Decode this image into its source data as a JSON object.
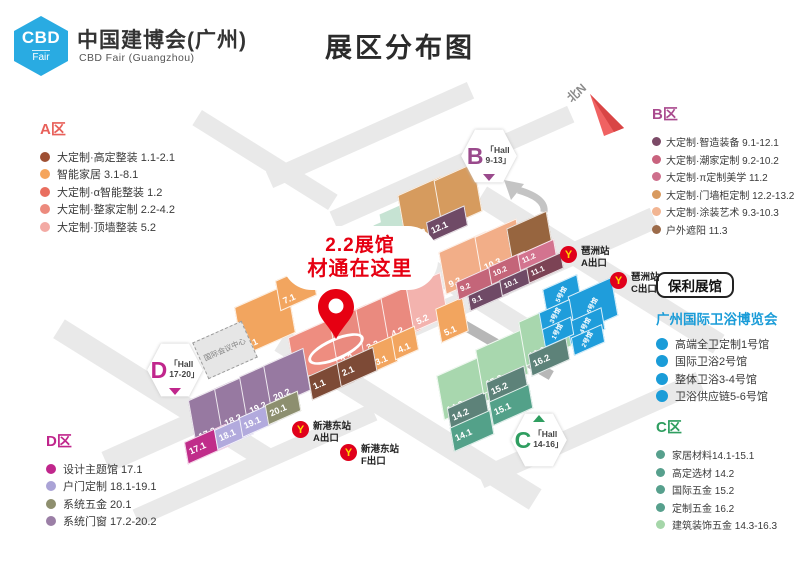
{
  "header": {
    "logo_abbr": "CBD",
    "logo_sub": "Fair",
    "title_cn": "中国建博会(广州)",
    "title_en": "CBD Fair (Guangzhou)",
    "page_title": "展区分布图"
  },
  "compass": {
    "label": "北N"
  },
  "legend_a": {
    "title": "A区",
    "items": [
      {
        "label": "大定制·高定整装 1.1-2.1",
        "color": "#9e4f33"
      },
      {
        "label": "智能家居 3.1-8.1",
        "color": "#f5a55c"
      },
      {
        "label": "大定制·α智能整装 1.2",
        "color": "#e96e5f"
      },
      {
        "label": "大定制·整家定制 2.2-4.2",
        "color": "#ec8a7d"
      },
      {
        "label": "大定制·顶墙整装 5.2",
        "color": "#f3aaa4"
      }
    ]
  },
  "legend_b": {
    "title": "B区",
    "items": [
      {
        "label": "大定制·智造装备 9.1-12.1",
        "color": "#7c4a67"
      },
      {
        "label": "大定制·潮家定制 9.2-10.2",
        "color": "#c9637e"
      },
      {
        "label": "大定制·π定制美学 11.2",
        "color": "#ce6f8c"
      },
      {
        "label": "大定制·门墙柜定制 12.2-13.2",
        "color": "#d89a5f"
      },
      {
        "label": "大定制·涂装艺术 9.3-10.3",
        "color": "#f2b592"
      },
      {
        "label": "户外遮阳 11.3",
        "color": "#9c6b4a"
      }
    ]
  },
  "poly": {
    "badge": "保利展馆",
    "title": "广州国际卫浴博览会",
    "items": [
      {
        "label": "高端全卫定制1号馆"
      },
      {
        "label": "国际卫浴2号馆"
      },
      {
        "label": "整体卫浴3-4号馆"
      },
      {
        "label": "卫浴供应链5-6号馆"
      }
    ]
  },
  "legend_c": {
    "title": "C区",
    "items": [
      {
        "label": "家居材料14.1-15.1",
        "color": "#57a08d"
      },
      {
        "label": "高定选材 14.2",
        "color": "#57a08d"
      },
      {
        "label": "国际五金 15.2",
        "color": "#57a08d"
      },
      {
        "label": "定制五金 16.2",
        "color": "#57a08d"
      },
      {
        "label": "建筑装饰五金 14.3-16.3",
        "color": "#a5d6a9"
      }
    ]
  },
  "legend_d": {
    "title": "D区",
    "items": [
      {
        "label": "设计主题馆 17.1",
        "color": "#c0268c"
      },
      {
        "label": "户门定制 18.1-19.1",
        "color": "#aaa3d6"
      },
      {
        "label": "系统五金 20.1",
        "color": "#8e8f6e"
      },
      {
        "label": "系统门窗 17.2-20.2",
        "color": "#9b7fa6"
      }
    ]
  },
  "callout": {
    "line1": "2.2展馆",
    "line2": "材通在这里"
  },
  "map": {
    "conference": "国际会议中心",
    "halls": {
      "h1_1": "1.1",
      "h1_2": "1.2",
      "h2_1": "2.1",
      "h2_2": "2.2",
      "h3_1": "3.1",
      "h3_2": "3.2",
      "h4_1": "4.1",
      "h4_2": "4.2",
      "h5_1": "5.1",
      "h5_2": "5.2",
      "h6_1": "6.1",
      "h7_1": "7.1",
      "h9_1": "9.1",
      "h9_2": "9.2",
      "h9_3": "9.3",
      "h10_1": "10.1",
      "h10_2": "10.2",
      "h10_3": "10.3",
      "h11_1": "11.1",
      "h11_2": "11.2",
      "h11_3": "11.3",
      "h12_1": "12.1",
      "h12_2": "12.2",
      "h13_2": "13.2",
      "h14_1": "14.1",
      "h14_2": "14.2",
      "h14_3": "14.3",
      "h15_1": "15.1",
      "h15_2": "15.2",
      "h15_3": "15.3",
      "h16_2": "16.2",
      "h16_3": "16.3",
      "h17_1": "17.1",
      "h17_2": "17.2",
      "h18_1": "18.1",
      "h18_2": "18.2",
      "h19_1": "19.1",
      "h19_2": "19.2",
      "h20_1": "20.1",
      "h20_2": "20.2"
    },
    "poly_halls": {
      "p1": "1号馆",
      "p2": "2号馆",
      "p3": "3号馆",
      "p4": "4号馆",
      "p5": "5号馆",
      "p6": "6号馆"
    },
    "hex": {
      "b": {
        "letter": "B",
        "line1": "「Hall",
        "line2": "9-13」"
      },
      "c": {
        "letter": "C",
        "line1": "「Hall",
        "line2": "14-16」"
      },
      "d": {
        "letter": "D",
        "line1": "「Hall",
        "line2": "17-20」"
      }
    }
  },
  "metro": {
    "glyph": "Y",
    "stations": [
      {
        "name": "新港东站",
        "exit": "A出口"
      },
      {
        "name": "新港东站",
        "exit": "F出口"
      },
      {
        "name": "琶洲站",
        "exit": "A出口"
      },
      {
        "name": "琶洲站",
        "exit": "C出口"
      }
    ]
  },
  "colors": {
    "brand_cyan": "#29abe2",
    "highlight_red": "#e60012",
    "poly_blue": "#1f9ddb",
    "metro_red": "#e0001b",
    "metro_yellow": "#ffd800",
    "legend_a_title": "#e8605a",
    "legend_b_title": "#a94a8e",
    "legend_c_title": "#2f9e60",
    "legend_d_title": "#c0268c"
  }
}
